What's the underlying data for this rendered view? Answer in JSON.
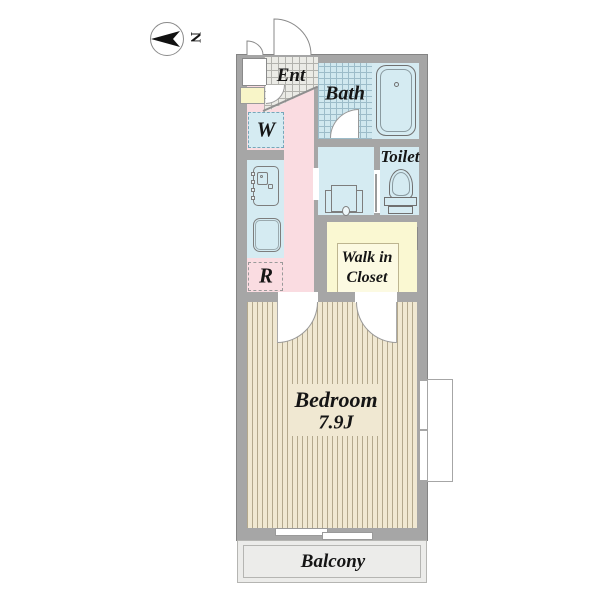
{
  "title": "apartment-floor-plan",
  "compass": {
    "label": "N"
  },
  "rooms": {
    "entrance": {
      "label": "Ent"
    },
    "bath": {
      "label": "Bath"
    },
    "toilet": {
      "label": "Toilet"
    },
    "washer": {
      "label": "W"
    },
    "refrigerator": {
      "label": "R"
    },
    "walk_in_closet": {
      "label_line1": "Walk in",
      "label_line2": "Closet"
    },
    "bedroom": {
      "label": "Bedroom",
      "size": "7.9J"
    },
    "balcony": {
      "label": "Balcony"
    }
  },
  "fixtures": [
    "bathtub",
    "toilet-bowl",
    "washbasin",
    "stove",
    "kitchen-sink",
    "washing-machine-space",
    "refrigerator-space",
    "pipe-space",
    "shoe-cabinet"
  ],
  "colors": {
    "wall": "#a6a6a6",
    "pink": "#fadce1",
    "blue": "#d5ebf2",
    "yellow": "#faf8d2",
    "yellowInner": "#fcfae2",
    "paleYellow": "#f8f5c8",
    "cream": "#f0e8d2",
    "stripe": "#b3a88d",
    "balcony": "#ececea",
    "text": "#151515"
  }
}
